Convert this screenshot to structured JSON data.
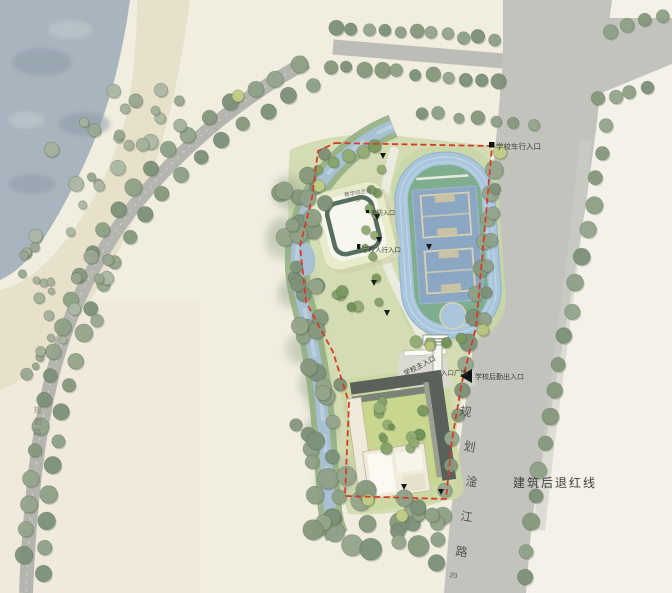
{
  "plan": {
    "setback_label": "建筑后退红线",
    "road": {
      "name_chars": [
        "规",
        "划",
        "淦",
        "江",
        "路"
      ],
      "width_label": "20"
    },
    "left_road_label": "规划路",
    "entrances": {
      "vehicle": "学校车行入口",
      "main": "学校主入口",
      "plaza": "入口广场",
      "logistics": "学校后勤出入口",
      "pedestrian": "学校人行入口",
      "fire": "消防入口"
    },
    "buildings": {
      "north_label_l1": "教学综合楼",
      "north_label_l2": "3F"
    },
    "colors": {
      "boundary_red": "#d93a28",
      "track_blue": "#a9c6dd",
      "field_blue": "#8ba7c3",
      "infield_green": "#7fae8e",
      "water": "#a9b5be",
      "road_gray": "#c3c3bd",
      "site_green": "#d4dcb4"
    }
  }
}
